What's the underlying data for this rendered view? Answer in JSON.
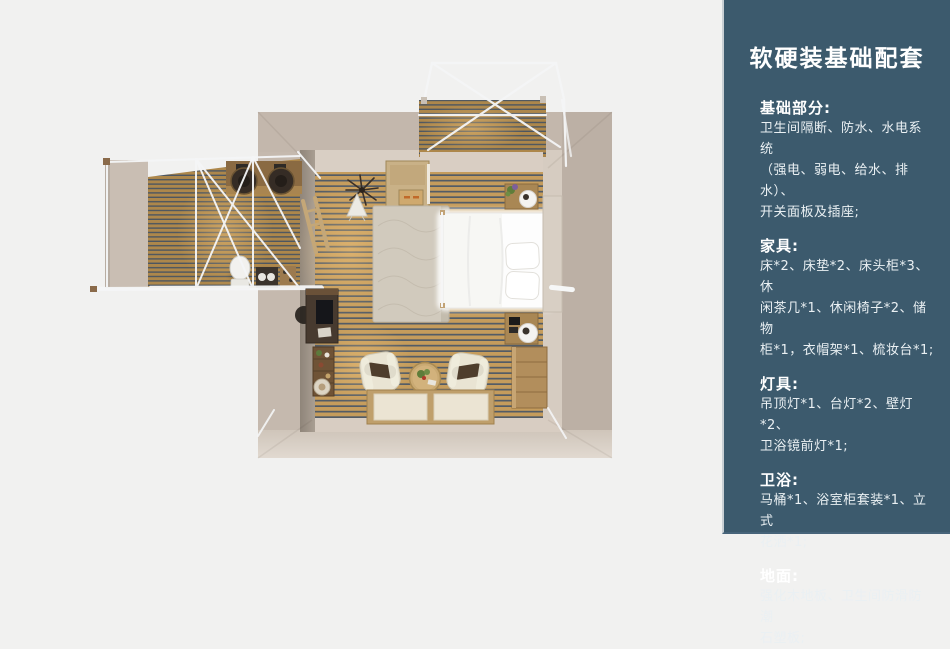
{
  "slide": {
    "background_color": "#f1f1f0"
  },
  "sidebar": {
    "background_color": "#3c5a6d",
    "text_color": "#eef2f4",
    "title": "软硬装基础配套",
    "sections": [
      {
        "heading": "基础部分:",
        "body": "卫生间隔断、防水、水电系统\n（强电、弱电、给水、排水）、\n开关面板及插座;"
      },
      {
        "heading": "家具:",
        "body": "床*2、床垫*2、床头柜*3、休\n闲茶几*1、休闲椅子*2、储物\n柜*1，衣帽架*1、梳妆台*1;"
      },
      {
        "heading": "灯具:",
        "body": "吊顶灯*1、台灯*2、壁灯*2、\n卫浴镜前灯*1;"
      },
      {
        "heading": "卫浴:",
        "body": "马桶*1、浴室柜套装*1、立式\n花洒*1;"
      },
      {
        "heading": "地面:",
        "body": "强化木地板、卫生间防滑防潮\n石塑板;"
      }
    ]
  },
  "floor_plan": {
    "description": "top-down 3D render of a bedroom suite with bathroom wing and front deck",
    "palette": {
      "wall_outer": "#c5b9ae",
      "wall_inner_light": "#d9cfc4",
      "wall_inner_shadow": "#8f857a",
      "floor_wood": "#c59c5c",
      "deck_wood": "#ad874b",
      "slat_gap": "#535c66",
      "frame_white": "#f5f6f7",
      "bed_white": "#fdfdfd",
      "rug": "#d1cabd"
    }
  }
}
